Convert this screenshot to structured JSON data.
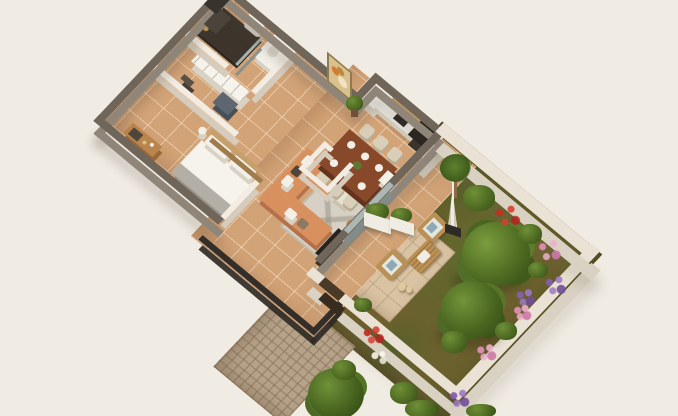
{
  "scene": {
    "title": "3D isometric apartment floor plan with private garden",
    "background_color": "#f1ece3",
    "view": "isometric top-down render, no visible text"
  },
  "palette": {
    "exterior_wall_top": "#6f6559",
    "exterior_wall_face": "#8f8679",
    "interior_wall": "#f2ece2",
    "garden_wall": "#eae3d5",
    "floor_tile": "#d2a377",
    "patio_tile": "#d9c3a2",
    "grass": "#6b612e",
    "driveway_cobble": "#b5a289",
    "sofa_terracotta": "#d9905f",
    "wood": "#b9854c",
    "dark_fixture": "#26221e",
    "railing": "#332e29",
    "flower_red": "#c62e24",
    "flower_pink": "#df8db4",
    "flower_purple": "#865fac"
  },
  "rooms": {
    "bedroom": {
      "label": "Bedroom"
    },
    "dressing": {
      "label": "Dressing area"
    },
    "bathroom": {
      "label": "Bathroom with walk-in shower"
    },
    "wc": {
      "label": "Separate WC"
    },
    "hall": {
      "label": "Hallway"
    },
    "living": {
      "label": "Living room"
    },
    "dining": {
      "label": "Dining area"
    },
    "kitchen": {
      "label": "Open kitchen"
    },
    "terrace": {
      "label": "Railed terrace"
    },
    "patio": {
      "label": "Garden patio"
    },
    "garden": {
      "label": "Private garden"
    },
    "driveway": {
      "label": "Cobbled driveway"
    },
    "gate": {
      "label": "Entrance gate"
    }
  },
  "furniture": {
    "bed": {
      "label": "Double bed with white duvet and grey throw"
    },
    "desk": {
      "label": "Dresser with mirror"
    },
    "wardrobe": {
      "label": "White wardrobe unit"
    },
    "console": {
      "label": "Blue-grey drawer console"
    },
    "shower": {
      "label": "Dark tiled walk-in shower"
    },
    "bath_sink": {
      "label": "Vanity sink"
    },
    "toilet": {
      "label": "Toilet"
    },
    "sofa": {
      "label": "L-shaped terracotta sofa with cushions"
    },
    "rug": {
      "label": "Light grey patterned rug"
    },
    "tv": {
      "label": "TV panel"
    },
    "dining_table": {
      "label": "Wooden dining table, 6 place settings"
    },
    "dining_chairs": {
      "label": "6 cream dining chairs"
    },
    "kitchen_counter": {
      "label": "Kitchen counter with wood niche"
    },
    "oven": {
      "label": "Dark oven column"
    },
    "fridge": {
      "label": "White tall cabinet"
    },
    "washer": {
      "label": "White appliance"
    },
    "armchair_1": {
      "label": "Patio wooden armchair"
    },
    "armchair_2": {
      "label": "Patio wooden armchair"
    },
    "coffee_table": {
      "label": "Patio slatted coffee table"
    },
    "parasol": {
      "label": "Closed white parasol on black base"
    },
    "planters": {
      "label": "White planter boxes with shrubs"
    },
    "lanterns": {
      "label": "Rope lanterns"
    },
    "painting": {
      "label": "Framed wall art"
    },
    "plant": {
      "label": "Potted green plant"
    }
  },
  "garden_items": {
    "trees": [
      "Large leafy tree (center)",
      "Leafy tree (lower right)",
      "Leafy tree (bottom edge)"
    ],
    "palm": "Small palm by the house corner",
    "flower_beds": [
      "red shrub",
      "pink shrub",
      "purple shrub",
      "white flowers",
      "green bushes along walls"
    ]
  }
}
